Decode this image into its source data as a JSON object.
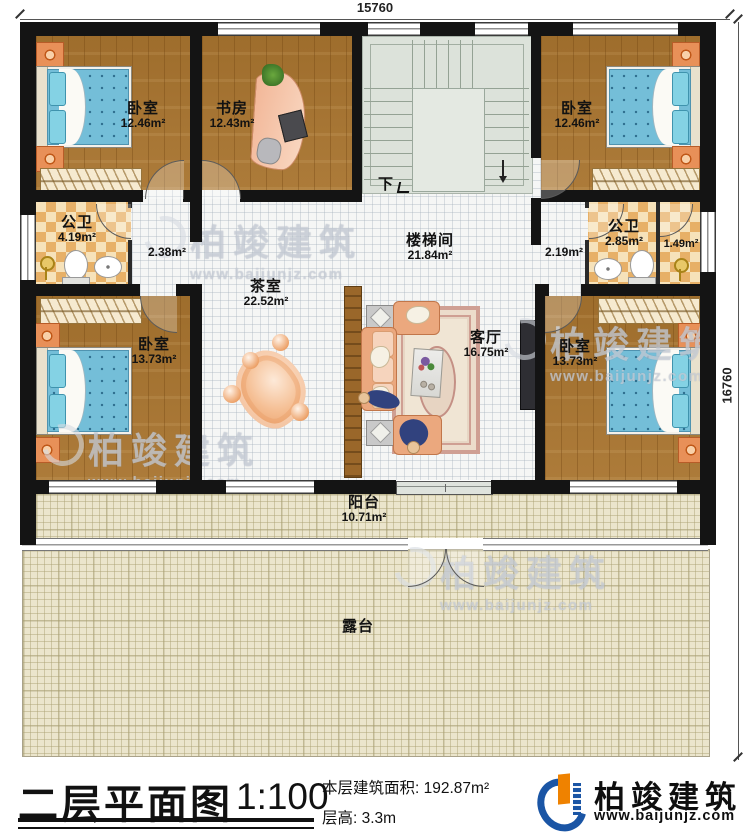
{
  "dimensions": {
    "width": "15760",
    "height": "16760"
  },
  "rooms": {
    "bedroom_tl": {
      "name": "卧室",
      "area": "12.46m²"
    },
    "study": {
      "name": "书房",
      "area": "12.43m²"
    },
    "bedroom_tr": {
      "name": "卧室",
      "area": "12.46m²"
    },
    "bath_left": {
      "name": "公卫",
      "area": "4.19m²"
    },
    "hall_left": {
      "area": "2.38m²"
    },
    "stairwell": {
      "name": "楼梯间",
      "area": "21.84m²"
    },
    "hall_right": {
      "area": "2.19m²"
    },
    "bath_right": {
      "name": "公卫",
      "area": "2.85m²"
    },
    "shower_right": {
      "area": "1.49m²"
    },
    "tea_room": {
      "name": "茶室",
      "area": "22.52m²"
    },
    "living_room": {
      "name": "客厅",
      "area": "16.75m²"
    },
    "bedroom_bl": {
      "name": "卧室",
      "area": "13.73m²"
    },
    "bedroom_br": {
      "name": "卧室",
      "area": "13.73m²"
    },
    "balcony": {
      "name": "阳台",
      "area": "10.71m²"
    },
    "terrace": {
      "name": "露台"
    }
  },
  "stairs": {
    "down_label": "下"
  },
  "watermark": {
    "brand": "柏竣建筑",
    "url": "www.baijunjz.com"
  },
  "title_block": {
    "title": "二层平面图",
    "scale": "1:100",
    "area_label": "本层建筑面积:",
    "area_value": "192.87m²",
    "height_label": "层高:",
    "height_value": "3.3m"
  },
  "logo": {
    "brand": "柏竣建筑",
    "url": "www.baijunjz.com"
  },
  "colors": {
    "wall": "#141414",
    "wood_floor": "#a8742f",
    "tile": "#f5f6f5",
    "bath_tile": "#e7b067",
    "stair": "#dce2da",
    "outdoor": "#ebe5cc",
    "bed": "#74bed8",
    "sofa": "#eba87e",
    "logo_blue": "#1a55a5",
    "logo_orange": "#ef8200"
  }
}
